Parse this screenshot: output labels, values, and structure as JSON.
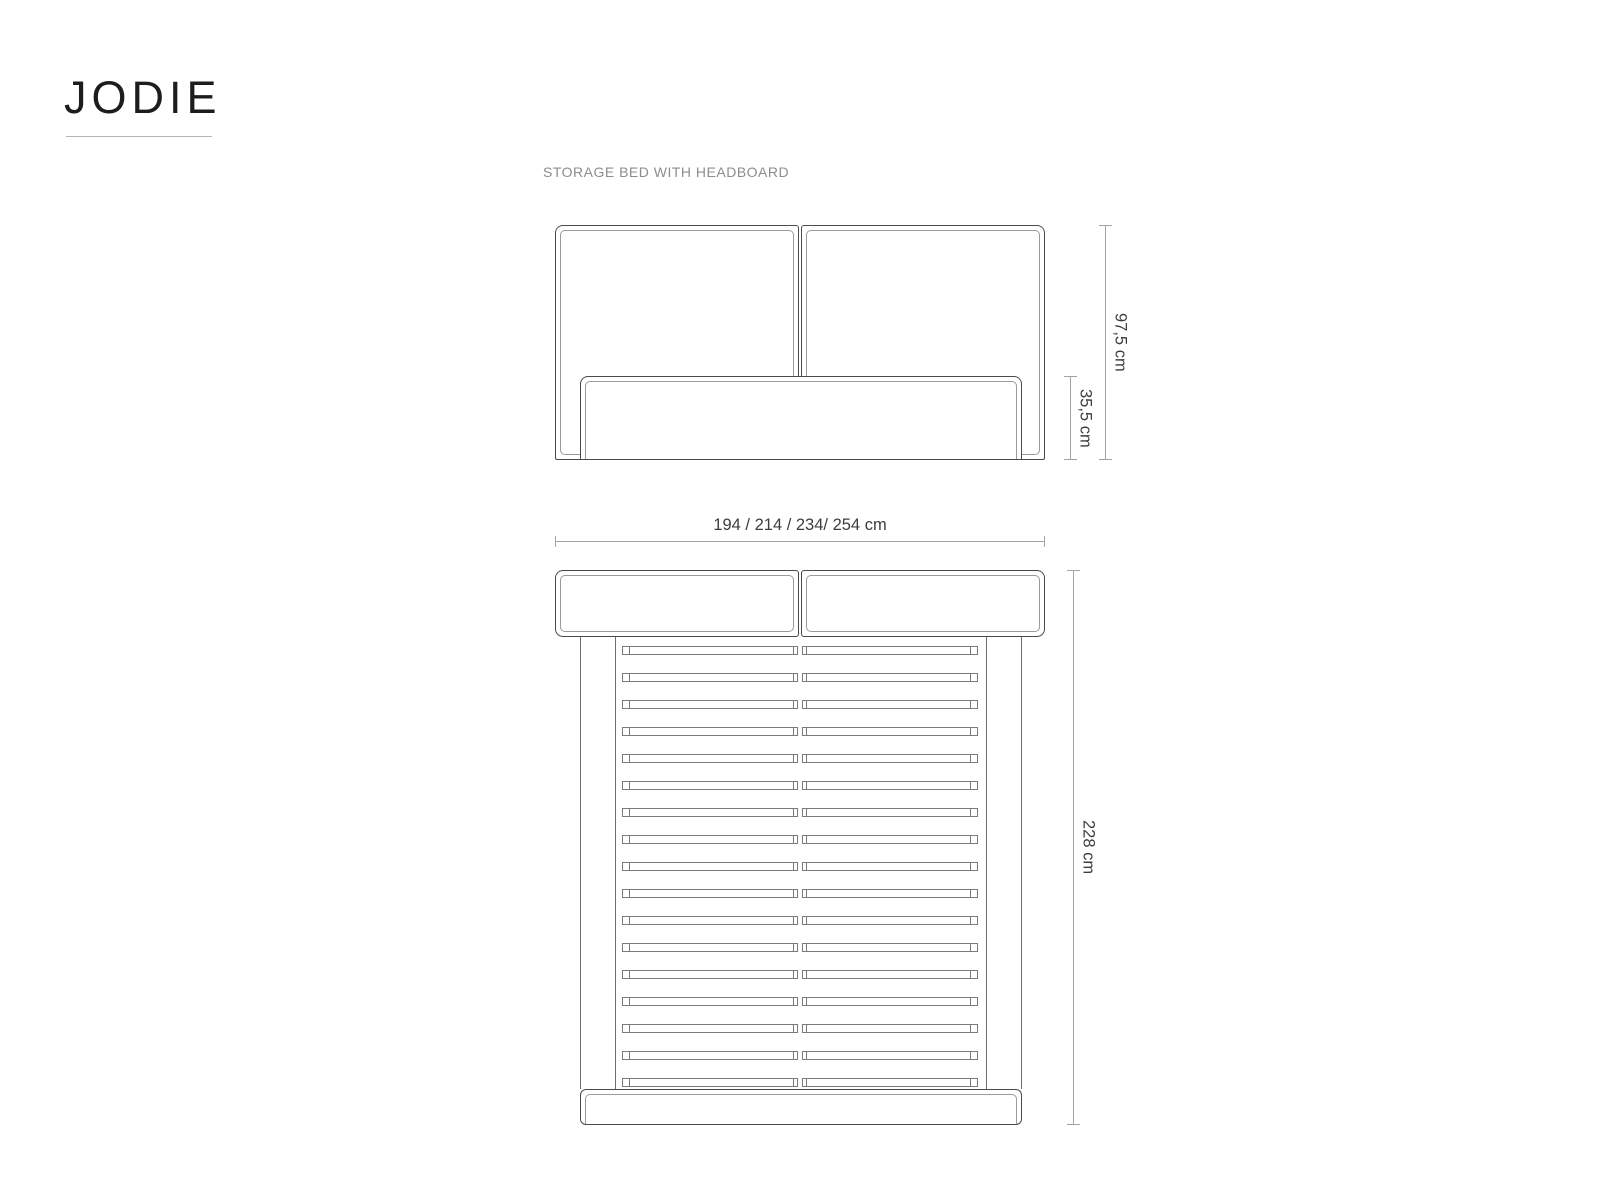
{
  "page": {
    "brand": "JODIE",
    "subtitle": "STORAGE BED WITH HEADBOARD"
  },
  "front_view": {
    "label_headboard_height": "97,5 cm",
    "label_base_height": "35,5 cm"
  },
  "width_dimension": "194 / 214 / 234/ 254 cm",
  "top_view": {
    "label_length": "228 cm",
    "slat_count": 17
  },
  "colors": {
    "outline": "#4a4a4a",
    "inner_line": "#9b9b9b",
    "slat_line": "#7a7a7a",
    "rail_line": "#6e6e6e",
    "dim_line": "#a3a3a3",
    "dim_text": "#3d3d3d",
    "subtitle_text": "#8d8d8d",
    "logo_text": "#1d1d1d"
  }
}
